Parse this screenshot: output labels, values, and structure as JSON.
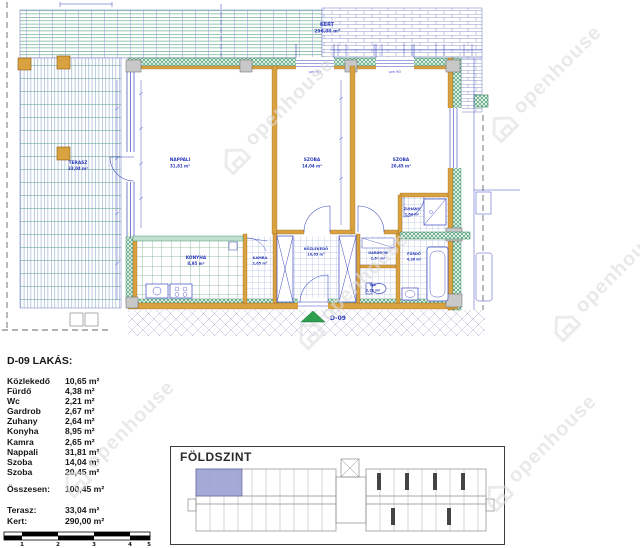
{
  "watermark": {
    "text": "openhouse"
  },
  "plan": {
    "labels": [
      {
        "name": "KERT",
        "area": "290,00 m²"
      },
      {
        "name": "TERASZ",
        "area": "33,04 m²"
      },
      {
        "name": "NAPPALI",
        "area": "31,81 m²"
      },
      {
        "name": "SZOBA",
        "area": "14,04 m²"
      },
      {
        "name": "SZOBA",
        "area": "20,45 m²"
      },
      {
        "name": "KONYHA",
        "area": "8,95 m²"
      },
      {
        "name": "KAMRA",
        "area": "2,65 m²"
      },
      {
        "name": "KÖZLEKEDŐ",
        "area": "10,65 m²"
      },
      {
        "name": "GARDROB",
        "area": "2,67 m²"
      },
      {
        "name": "WC",
        "area": "2,21 m²"
      },
      {
        "name": "ZUHANY",
        "area": "2,64 m²"
      },
      {
        "name": "FÜRDŐ",
        "area": "4,38 m²"
      }
    ],
    "entrance_label": "D-09",
    "dims": [
      "pm 90",
      "pm 90"
    ]
  },
  "summary": {
    "title": "D-09 LAKÁS:",
    "rooms": [
      {
        "label": "Közlekedő",
        "value": "10,65 m²"
      },
      {
        "label": "Fürdő",
        "value": "4,38 m²"
      },
      {
        "label": "Wc",
        "value": "2,21 m²"
      },
      {
        "label": "Gardrob",
        "value": "2,67 m²"
      },
      {
        "label": "Zuhany",
        "value": "2,64 m²"
      },
      {
        "label": "Konyha",
        "value": "8,95 m²"
      },
      {
        "label": "Kamra",
        "value": "2,65 m²"
      },
      {
        "label": "Nappali",
        "value": "31,81 m²"
      },
      {
        "label": "Szoba",
        "value": "14,04 m²"
      },
      {
        "label": "Szoba",
        "value": "20,45 m²"
      }
    ],
    "total": {
      "label": "Összesen:",
      "value": "100,45 m²"
    },
    "extras": [
      {
        "label": "Terasz:",
        "value": "33,04 m²"
      },
      {
        "label": "Kert:",
        "value": "290,00 m²"
      }
    ]
  },
  "overview": {
    "title": "FÖLDSZINT"
  },
  "scalebar": {
    "ticks": [
      "1",
      "2",
      "3",
      "4",
      "5"
    ]
  },
  "colors": {
    "wall_orange": "#d9a13f",
    "insulation_green": "#2f8f62",
    "line_blue": "#3a49c0",
    "highlight_unit": "#9aa0d0",
    "entrance_green": "#2e9e4f"
  }
}
